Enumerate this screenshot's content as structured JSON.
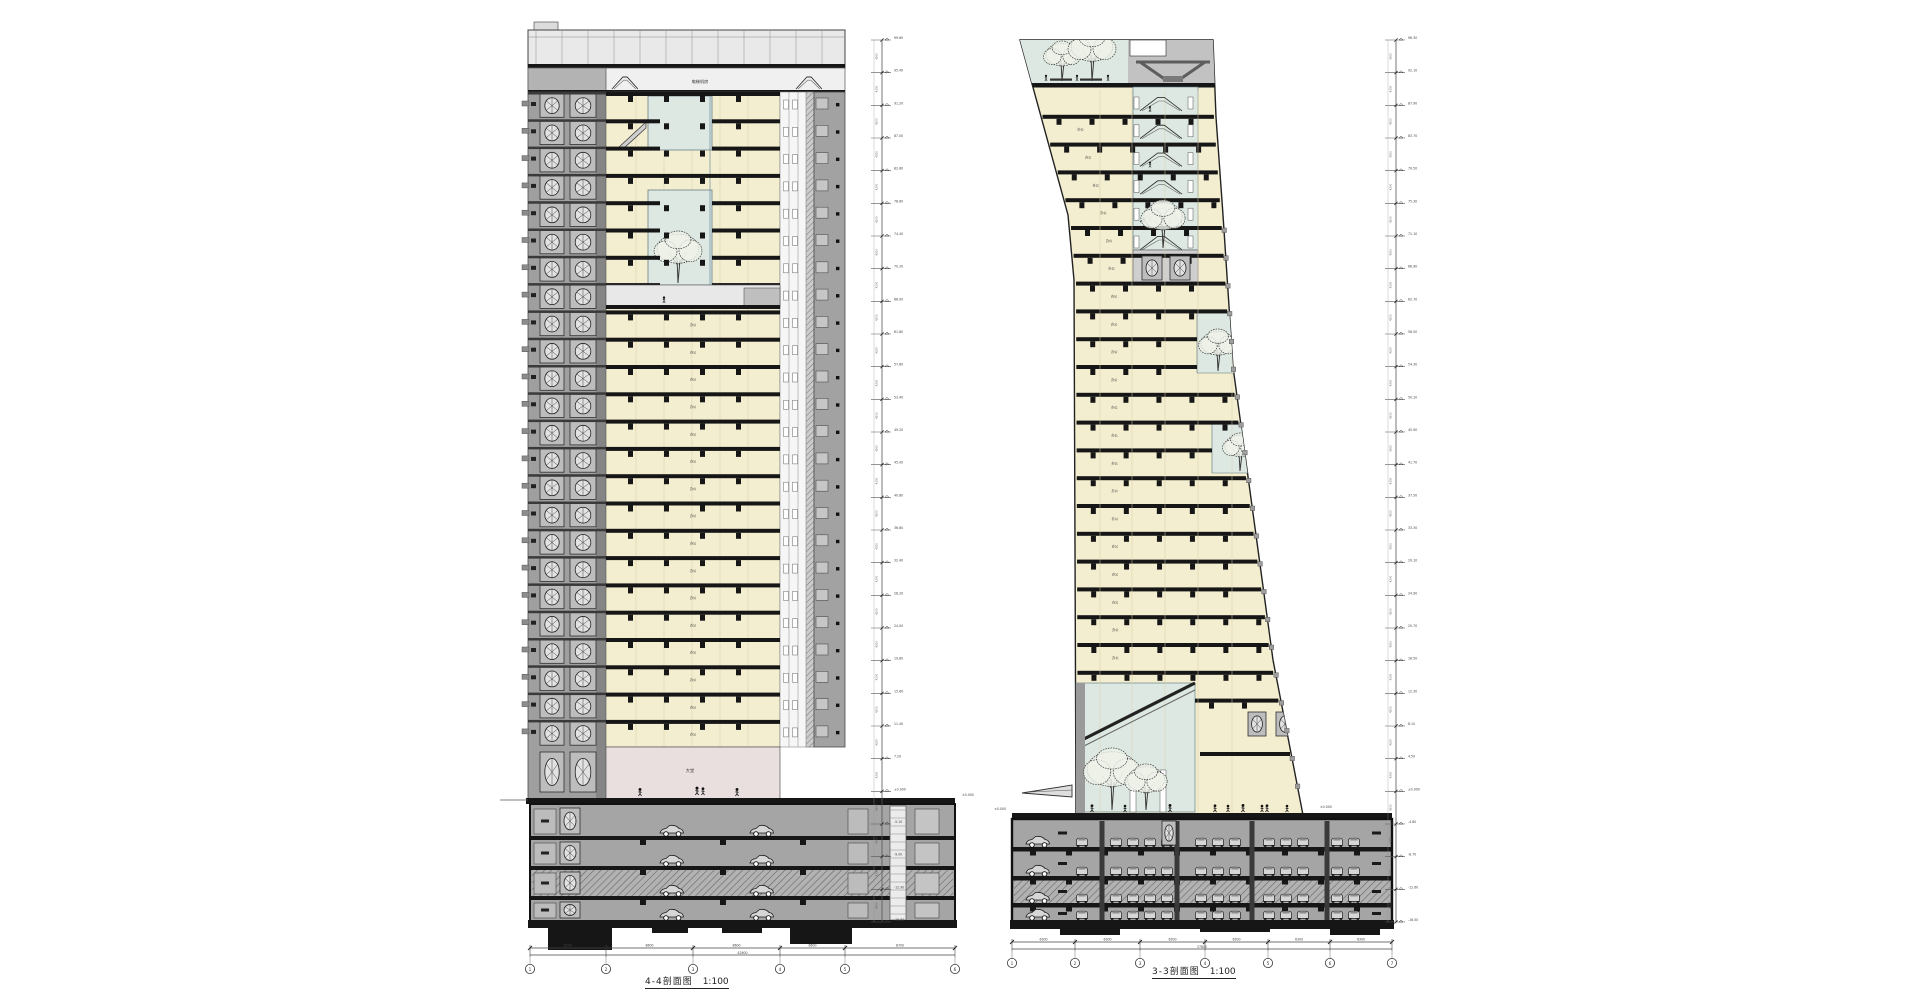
{
  "labels": {
    "left_title": "4-4剖面图",
    "right_title": "3-3剖面图",
    "scale": "1:100"
  },
  "left_section": {
    "mech_label": "电梯机房",
    "floor_label": "办公",
    "lobby_label": "大堂",
    "ground_mark": "±0.000",
    "level_step": "4200",
    "levels": [
      "99.60",
      "95.40",
      "91.20",
      "87.00",
      "82.80",
      "78.60",
      "74.40",
      "70.20",
      "66.00",
      "61.80",
      "57.60",
      "53.40",
      "49.20",
      "45.00",
      "40.80",
      "36.60",
      "32.40",
      "28.20",
      "24.00",
      "19.80",
      "15.60",
      "11.40",
      "7.20",
      "±0.000",
      "-5.10",
      "-9.00",
      "-12.90",
      "-16.80"
    ],
    "grid_bubbles": [
      "1",
      "2",
      "3",
      "4",
      "5",
      "6"
    ],
    "span_dims": [
      "8100",
      "8600",
      "8600",
      "8600",
      "8700"
    ],
    "total_dim": "42600"
  },
  "right_section": {
    "floor_label": "办公",
    "ground_mark": "±0.000",
    "level_step": "4200",
    "levels": [
      "96.30",
      "92.10",
      "87.90",
      "83.70",
      "79.50",
      "75.30",
      "71.10",
      "66.90",
      "62.70",
      "58.50",
      "54.30",
      "50.10",
      "45.90",
      "41.70",
      "37.50",
      "33.30",
      "29.10",
      "24.90",
      "20.70",
      "16.50",
      "12.30",
      "8.10",
      "4.50",
      "±0.000",
      "-4.80",
      "-8.70",
      "-12.60",
      "-16.50"
    ],
    "grid_bubbles": [
      "1",
      "2",
      "3",
      "4",
      "5",
      "6",
      "7"
    ],
    "span_dims": [
      "6300",
      "6300",
      "6300",
      "6300",
      "6300",
      "6300"
    ],
    "total_dim": "37800"
  },
  "colors": {
    "cream": "#f3eecf",
    "atrium": "#dde8e2",
    "core_gray": "#9f9f9f",
    "core_light": "#c2c2c2",
    "crown": "#e9e9e9",
    "mech": "#c2c2c2",
    "lobby": "#eadfdf",
    "basement": "#a5a5a5",
    "slab": "#161616",
    "line": "#2a2a2a"
  }
}
